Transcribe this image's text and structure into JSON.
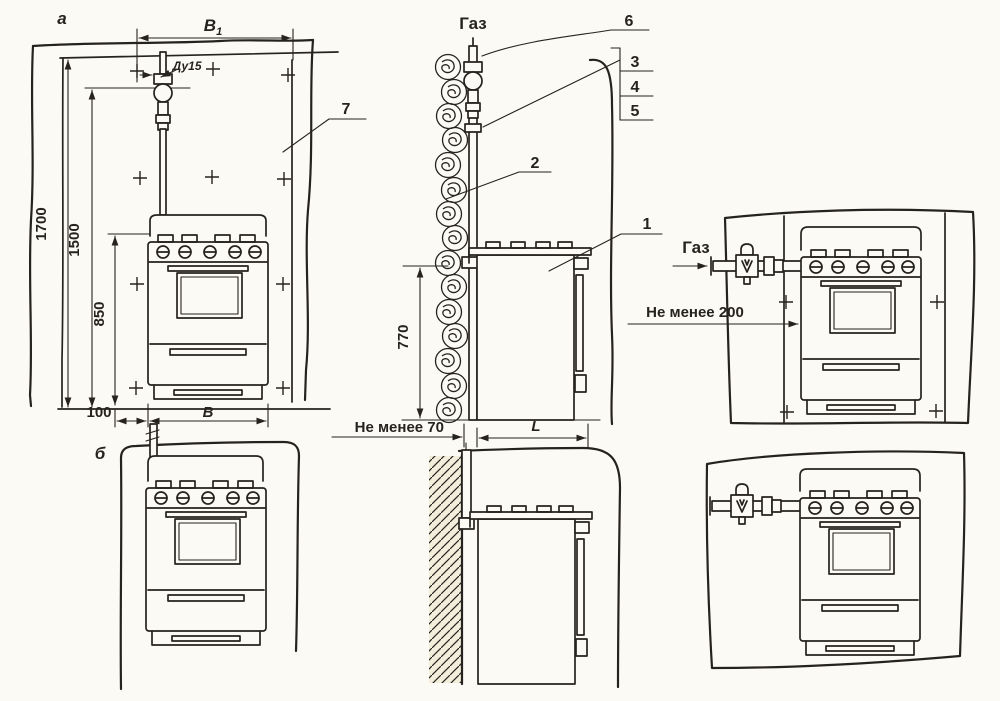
{
  "fig_a": {
    "label": "а"
  },
  "fig_b": {
    "label": "б"
  },
  "gas": {
    "top": "Газ",
    "right": "Газ"
  },
  "dims": {
    "b1": {
      "base": "В",
      "sub": "1"
    },
    "du": "Ду15",
    "h1700": "1700",
    "h1500": "1500",
    "h850": "850",
    "w100": "100",
    "wb": "В",
    "h770": "770",
    "min70": "Не менее 70",
    "depthL": "L",
    "min200": "Не менее 200"
  },
  "callouts": {
    "n1": "1",
    "n2": "2",
    "n3": "3",
    "n4": "4",
    "n5": "5",
    "n6": "6",
    "n7": "7"
  },
  "colors": {
    "ink": "#262220",
    "paper": "#fbfaf5",
    "wall_tint": "#f2eedb"
  }
}
